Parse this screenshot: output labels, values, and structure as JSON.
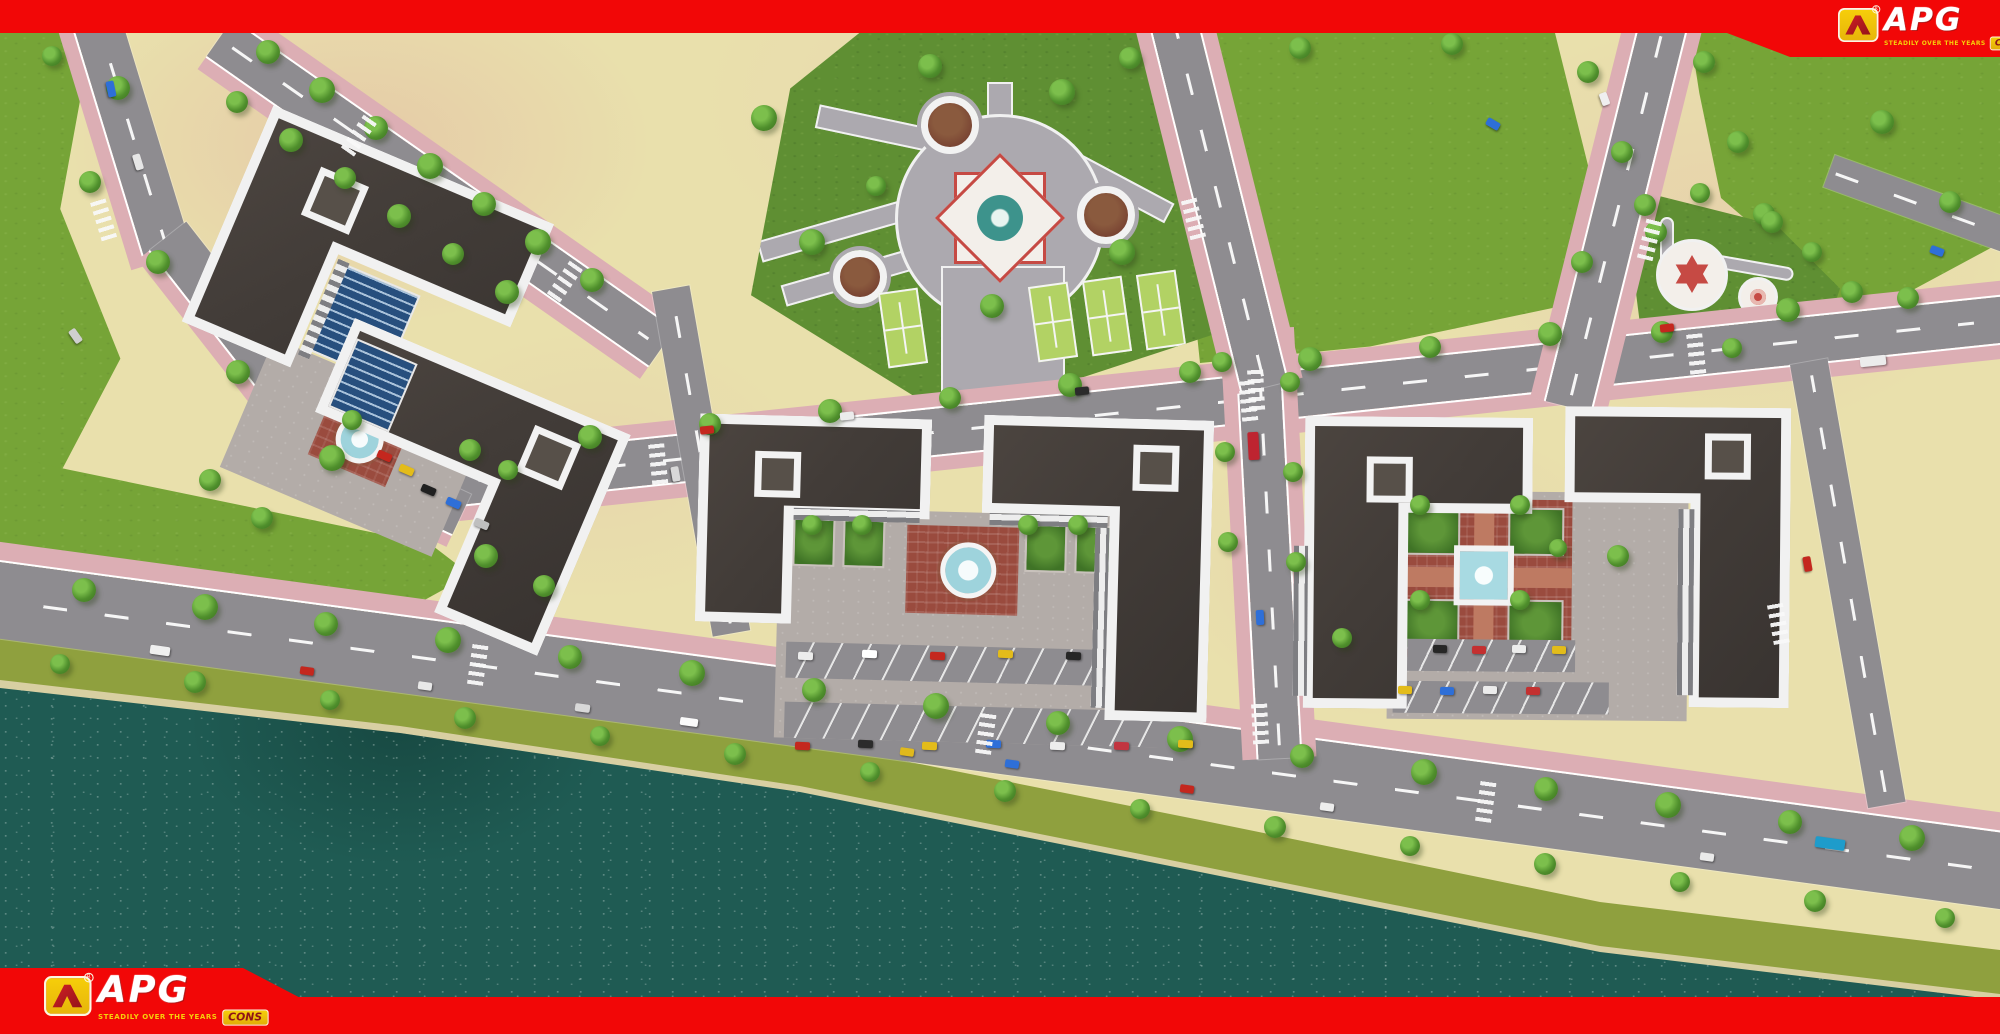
{
  "brand": {
    "name": "APG",
    "cons": "CONS",
    "tagline": "STEADILY OVER THE YEARS"
  },
  "palette": {
    "frameRed": "#F20707",
    "logoYellow": "#F6CE0A",
    "logoDeepRed": "#8E1418",
    "parcel": "#E9E0AC",
    "road": "#8E8C90",
    "sidewalk": "#DCAEB4",
    "grass": "#76A437",
    "parkGrass": "#5F8F33",
    "bank": "#8FA03E",
    "sand": "#D8CFA2",
    "water": "#1F5B53",
    "plaza": "#ACA9AF",
    "tennis": "#B2D264",
    "brick": "#9A4B3E"
  },
  "scene": {
    "trees": [
      [
        268,
        52,
        24
      ],
      [
        322,
        90,
        26
      ],
      [
        376,
        128,
        24
      ],
      [
        430,
        166,
        26
      ],
      [
        484,
        204,
        24
      ],
      [
        538,
        242,
        26
      ],
      [
        592,
        280,
        24
      ],
      [
        237,
        102,
        22
      ],
      [
        291,
        140,
        24
      ],
      [
        345,
        178,
        22
      ],
      [
        399,
        216,
        24
      ],
      [
        453,
        254,
        22
      ],
      [
        507,
        292,
        24
      ],
      [
        118,
        88,
        24
      ],
      [
        90,
        182,
        22
      ],
      [
        158,
        262,
        24
      ],
      [
        238,
        372,
        24
      ],
      [
        332,
        458,
        26
      ],
      [
        52,
        56,
        20
      ],
      [
        210,
        480,
        22
      ],
      [
        262,
        518,
        22
      ],
      [
        486,
        556,
        24
      ],
      [
        544,
        586,
        22
      ],
      [
        84,
        590,
        24
      ],
      [
        205,
        607,
        26
      ],
      [
        326,
        624,
        24
      ],
      [
        448,
        640,
        26
      ],
      [
        570,
        657,
        24
      ],
      [
        692,
        673,
        26
      ],
      [
        814,
        690,
        24
      ],
      [
        936,
        706,
        26
      ],
      [
        1058,
        723,
        24
      ],
      [
        1180,
        739,
        26
      ],
      [
        1302,
        756,
        24
      ],
      [
        1424,
        772,
        26
      ],
      [
        1546,
        789,
        24
      ],
      [
        1668,
        805,
        26
      ],
      [
        1790,
        822,
        24
      ],
      [
        1912,
        838,
        26
      ],
      [
        60,
        664,
        20
      ],
      [
        195,
        682,
        22
      ],
      [
        330,
        700,
        20
      ],
      [
        465,
        718,
        22
      ],
      [
        600,
        736,
        20
      ],
      [
        735,
        754,
        22
      ],
      [
        870,
        772,
        20
      ],
      [
        1005,
        791,
        22
      ],
      [
        1140,
        809,
        20
      ],
      [
        1275,
        827,
        22
      ],
      [
        1410,
        846,
        20
      ],
      [
        1545,
        864,
        22
      ],
      [
        1680,
        882,
        20
      ],
      [
        1815,
        901,
        22
      ],
      [
        1945,
        918,
        20
      ],
      [
        470,
        450,
        22
      ],
      [
        590,
        437,
        24
      ],
      [
        710,
        424,
        22
      ],
      [
        830,
        411,
        24
      ],
      [
        950,
        398,
        22
      ],
      [
        1070,
        385,
        24
      ],
      [
        1190,
        372,
        22
      ],
      [
        1310,
        359,
        24
      ],
      [
        1430,
        347,
        22
      ],
      [
        1550,
        334,
        24
      ],
      [
        1788,
        310,
        24
      ],
      [
        1908,
        298,
        22
      ],
      [
        1222,
        362,
        20
      ],
      [
        1225,
        452,
        20
      ],
      [
        1228,
        542,
        20
      ],
      [
        1290,
        382,
        20
      ],
      [
        1293,
        472,
        20
      ],
      [
        1296,
        562,
        20
      ],
      [
        764,
        118,
        26
      ],
      [
        930,
        66,
        24
      ],
      [
        1062,
        92,
        26
      ],
      [
        812,
        242,
        26
      ],
      [
        1122,
        252,
        26
      ],
      [
        992,
        306,
        24
      ],
      [
        876,
        186,
        20
      ],
      [
        1645,
        205,
        22
      ],
      [
        1700,
        193,
        20
      ],
      [
        1764,
        214,
        22
      ],
      [
        1812,
        252,
        20
      ],
      [
        1662,
        332,
        22
      ],
      [
        1732,
        348,
        20
      ],
      [
        1582,
        262,
        22
      ],
      [
        1588,
        72,
        22
      ],
      [
        1622,
        152,
        22
      ],
      [
        1656,
        232,
        22
      ],
      [
        1704,
        62,
        22
      ],
      [
        1738,
        142,
        22
      ],
      [
        1772,
        222,
        22
      ],
      [
        1130,
        58,
        22
      ],
      [
        1300,
        48,
        22
      ],
      [
        1452,
        44,
        22
      ],
      [
        1882,
        122,
        24
      ],
      [
        1950,
        202,
        22
      ],
      [
        1852,
        292,
        22
      ],
      [
        812,
        525,
        20
      ],
      [
        862,
        525,
        20
      ],
      [
        1028,
        525,
        20
      ],
      [
        1078,
        525,
        20
      ],
      [
        1420,
        505,
        20
      ],
      [
        1520,
        505,
        20
      ],
      [
        1420,
        600,
        20
      ],
      [
        1520,
        600,
        20
      ],
      [
        1558,
        548,
        18
      ],
      [
        352,
        420,
        20
      ],
      [
        508,
        470,
        20
      ],
      [
        1618,
        556,
        22
      ],
      [
        1342,
        638,
        20
      ]
    ],
    "cars": [
      [
        103,
        85,
        16,
        8,
        "#2E6FD8",
        78
      ],
      [
        130,
        158,
        16,
        8,
        "#E6E6E6",
        73
      ],
      [
        68,
        332,
        15,
        8,
        "#CFCFCF",
        55
      ],
      [
        150,
        646,
        20,
        9,
        "#EFEFEF",
        8
      ],
      [
        300,
        667,
        14,
        8,
        "#C4271E",
        8
      ],
      [
        418,
        682,
        14,
        8,
        "#E8E8E8",
        8
      ],
      [
        575,
        704,
        15,
        8,
        "#D8D8D8",
        8
      ],
      [
        680,
        718,
        18,
        8,
        "#FAFAFA",
        8
      ],
      [
        900,
        748,
        14,
        8,
        "#E0B91C",
        8
      ],
      [
        1005,
        760,
        14,
        8,
        "#2E6FD8",
        8
      ],
      [
        1180,
        785,
        14,
        8,
        "#C4271E",
        8
      ],
      [
        1320,
        803,
        14,
        8,
        "#EDEDED",
        8
      ],
      [
        1700,
        853,
        14,
        8,
        "#EAEAEA",
        8
      ],
      [
        1815,
        838,
        30,
        11,
        "#1E9CCB",
        8
      ],
      [
        700,
        426,
        14,
        8,
        "#C4271E",
        -6
      ],
      [
        840,
        412,
        14,
        8,
        "#ECECEC",
        -6
      ],
      [
        1075,
        387,
        14,
        8,
        "#2B2B2B",
        -6
      ],
      [
        1660,
        324,
        14,
        8,
        "#C4271E",
        -6
      ],
      [
        1860,
        356,
        26,
        10,
        "#ECECEC",
        -6
      ],
      [
        1486,
        120,
        14,
        8,
        "#2E6FD8",
        30
      ],
      [
        1598,
        95,
        13,
        8,
        "#EFEFEF",
        70
      ],
      [
        1248,
        432,
        11,
        28,
        "#BE2430",
        -3
      ],
      [
        1256,
        610,
        8,
        15,
        "#2E6FD8",
        -3
      ],
      [
        668,
        470,
        15,
        8,
        "#D8D8D8",
        80
      ],
      [
        1800,
        560,
        15,
        8,
        "#C4271E",
        80
      ],
      [
        1930,
        247,
        14,
        8,
        "#2E6FD8",
        20
      ],
      [
        377,
        452,
        15,
        8,
        "#C4271E",
        23
      ],
      [
        399,
        466,
        15,
        8,
        "#E3BC1A",
        23
      ],
      [
        421,
        486,
        15,
        8,
        "#202020",
        23
      ],
      [
        446,
        499,
        15,
        8,
        "#2E6FD8",
        23
      ],
      [
        474,
        520,
        15,
        8,
        "#BFBFBF",
        23
      ],
      [
        798,
        652,
        15,
        8,
        "#ECECEC",
        2
      ],
      [
        862,
        650,
        15,
        8,
        "#FFFFFF",
        2
      ],
      [
        930,
        652,
        15,
        8,
        "#C4271E",
        2
      ],
      [
        998,
        650,
        15,
        8,
        "#E3BC1A",
        2
      ],
      [
        1066,
        652,
        15,
        8,
        "#262626",
        2
      ],
      [
        795,
        742,
        15,
        8,
        "#C4271E",
        2
      ],
      [
        858,
        740,
        15,
        8,
        "#2B2B2B",
        2
      ],
      [
        922,
        742,
        15,
        8,
        "#E3BC1A",
        2
      ],
      [
        986,
        740,
        15,
        8,
        "#2E6FD8",
        2
      ],
      [
        1050,
        742,
        15,
        8,
        "#EDEDED",
        2
      ],
      [
        1114,
        742,
        15,
        8,
        "#C23540",
        2
      ],
      [
        1178,
        740,
        15,
        8,
        "#E3BC1A",
        2
      ],
      [
        1433,
        645,
        14,
        8,
        "#262626",
        1
      ],
      [
        1472,
        646,
        14,
        8,
        "#C43030",
        1
      ],
      [
        1512,
        645,
        14,
        8,
        "#ECECEC",
        1
      ],
      [
        1552,
        646,
        14,
        8,
        "#E3BC1A",
        1
      ],
      [
        1398,
        686,
        14,
        8,
        "#E3BC1A",
        1
      ],
      [
        1440,
        687,
        14,
        8,
        "#2E6FD8",
        1
      ],
      [
        1483,
        686,
        14,
        8,
        "#ECECEC",
        1
      ],
      [
        1526,
        687,
        14,
        8,
        "#C43030",
        1
      ]
    ],
    "crosswalks": [
      [
        650,
        440,
        -6
      ],
      [
        1240,
        377,
        -6
      ],
      [
        1688,
        330,
        -6
      ],
      [
        978,
        710,
        8
      ],
      [
        1478,
        778,
        8
      ],
      [
        470,
        641,
        8
      ],
      [
        352,
        112,
        35
      ],
      [
        558,
        258,
        35
      ],
      [
        95,
        196,
        -17
      ],
      [
        1642,
        216,
        14
      ],
      [
        1185,
        195,
        -14
      ],
      [
        1770,
        600,
        -10
      ],
      [
        1248,
        366,
        -3
      ],
      [
        1252,
        700,
        -3
      ]
    ]
  }
}
